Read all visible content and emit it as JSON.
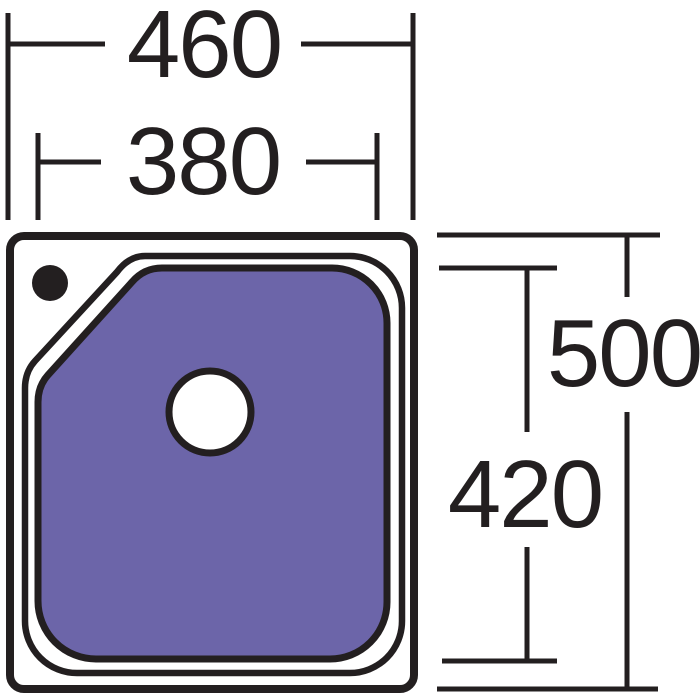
{
  "labels": {
    "overall_width": "460",
    "bowl_width": "380",
    "overall_depth": "500",
    "bowl_depth": "420"
  },
  "colors": {
    "line": "#231f20",
    "bowl_fill": "#6c65a9",
    "surface_fill": "#ffffff"
  }
}
